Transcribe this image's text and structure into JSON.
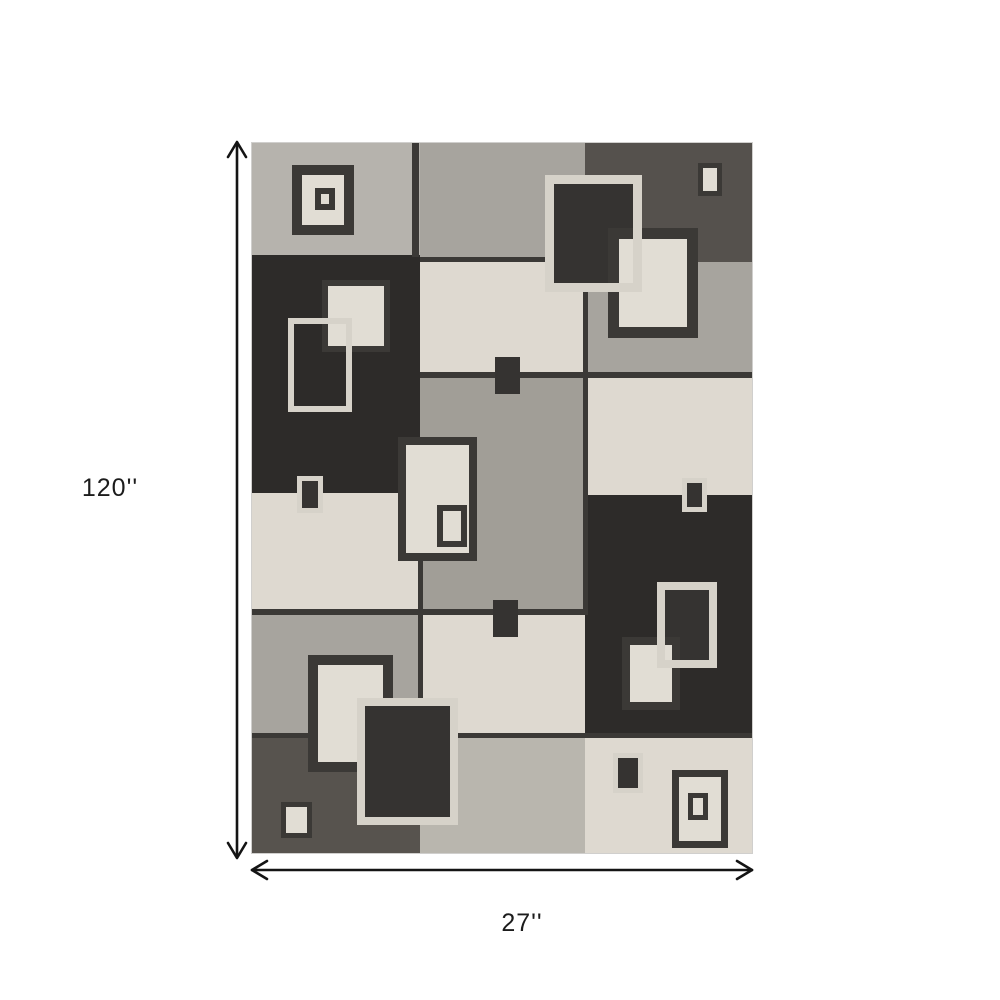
{
  "page": {
    "background": "#ffffff",
    "label_color": "#1c1c1c",
    "arrow_color": "#141414"
  },
  "dimensions": {
    "height_label": "120''",
    "width_label": "27''"
  },
  "rug": {
    "position": {
      "x": 252,
      "y": 143,
      "width": 500,
      "height": 710
    },
    "colors": {
      "black": "#2d2b29",
      "charcoal": "#55514d",
      "dark_gray": "#57534e",
      "medium_gray": "#a7a49e",
      "medium_gray2": "#a19e97",
      "light_gray": "#b6b3ad",
      "pale_gray": "#b9b6ae",
      "cream": "#ded9d0",
      "line": "#3b3936",
      "cream_border": "#d6d2c9",
      "dark_fill": "#353331",
      "cream_fill": "#e1ddd4"
    },
    "patches": [
      {
        "id": "a1",
        "x": 0,
        "y": 0,
        "w": 168,
        "h": 112,
        "color": "light_gray",
        "tx": "soft"
      },
      {
        "id": "a2",
        "x": 0,
        "y": 112,
        "w": 168,
        "h": 238,
        "color": "black",
        "tx": "strong"
      },
      {
        "id": "a3",
        "x": 0,
        "y": 350,
        "w": 168,
        "h": 118,
        "color": "cream",
        "tx": "cream"
      },
      {
        "id": "a4",
        "x": 0,
        "y": 468,
        "w": 168,
        "h": 124,
        "color": "medium_gray",
        "tx": "soft"
      },
      {
        "id": "a5",
        "x": 0,
        "y": 592,
        "w": 168,
        "h": 118,
        "color": "dark_gray",
        "tx": "strong"
      },
      {
        "id": "b1",
        "x": 168,
        "y": 0,
        "w": 165,
        "h": 117,
        "color": "medium_gray",
        "tx": "soft"
      },
      {
        "id": "b2",
        "x": 168,
        "y": 117,
        "w": 165,
        "h": 113,
        "color": "cream",
        "tx": "cream"
      },
      {
        "id": "b3",
        "x": 168,
        "y": 230,
        "w": 165,
        "h": 242,
        "color": "medium_gray2",
        "tx": "soft"
      },
      {
        "id": "b4",
        "x": 168,
        "y": 472,
        "w": 165,
        "h": 120,
        "color": "cream",
        "tx": "cream"
      },
      {
        "id": "b5",
        "x": 168,
        "y": 592,
        "w": 165,
        "h": 118,
        "color": "pale_gray",
        "tx": "soft"
      },
      {
        "id": "c1",
        "x": 333,
        "y": 0,
        "w": 167,
        "h": 119,
        "color": "charcoal",
        "tx": "strong"
      },
      {
        "id": "c2",
        "x": 333,
        "y": 119,
        "w": 167,
        "h": 115,
        "color": "medium_gray",
        "tx": "soft"
      },
      {
        "id": "c3",
        "x": 333,
        "y": 234,
        "w": 167,
        "h": 118,
        "color": "cream",
        "tx": "cream"
      },
      {
        "id": "c4",
        "x": 333,
        "y": 352,
        "w": 167,
        "h": 240,
        "color": "black",
        "tx": "strong"
      },
      {
        "id": "c5",
        "x": 333,
        "y": 592,
        "w": 167,
        "h": 118,
        "color": "cream",
        "tx": "cream"
      }
    ],
    "seams": [
      {
        "id": "seam-a1-b1",
        "x": 160,
        "y": 0,
        "w": 7,
        "h": 114,
        "color": "line"
      },
      {
        "id": "seam-b1-b2",
        "x": 168,
        "y": 114,
        "w": 165,
        "h": 5,
        "color": "line"
      },
      {
        "id": "seam-b2-b3",
        "x": 168,
        "y": 229,
        "w": 332,
        "h": 6,
        "color": "line"
      },
      {
        "id": "seam-a3-a4",
        "x": 0,
        "y": 466,
        "w": 333,
        "h": 6,
        "color": "line"
      },
      {
        "id": "seam-row-bottom",
        "x": 0,
        "y": 590,
        "w": 500,
        "h": 5,
        "color": "line"
      },
      {
        "id": "seam-a-b-vert",
        "x": 166,
        "y": 350,
        "w": 5,
        "h": 242,
        "color": "line"
      },
      {
        "id": "seam-b-c-vert",
        "x": 331,
        "y": 117,
        "w": 5,
        "h": 355,
        "color": "line"
      }
    ],
    "motifs": [
      {
        "id": "m1-outer",
        "x": 40,
        "y": 22,
        "w": 62,
        "h": 70,
        "border": 10,
        "border_color": "line",
        "fill": "cream_fill",
        "tx": "cream"
      },
      {
        "id": "m1-inner",
        "x": 63,
        "y": 45,
        "w": 20,
        "h": 22,
        "border": 6,
        "border_color": "line",
        "fill": "cream_fill"
      },
      {
        "id": "m2",
        "x": 446,
        "y": 20,
        "w": 24,
        "h": 33,
        "border": 5,
        "border_color": "line",
        "fill": "cream_fill"
      },
      {
        "id": "m3",
        "x": 293,
        "y": 32,
        "w": 97,
        "h": 117,
        "border": 9,
        "border_color": "cream_border",
        "fill": "dark_fill",
        "tx": "dark"
      },
      {
        "id": "m4",
        "x": 356,
        "y": 85,
        "w": 90,
        "h": 110,
        "border": 11,
        "border_color": "line",
        "fill": "cream_fill",
        "tx": "cream"
      },
      {
        "id": "m3-outline",
        "x": 293,
        "y": 32,
        "w": 97,
        "h": 117,
        "border": 9,
        "border_color": "cream_border",
        "fill": null
      },
      {
        "id": "m6",
        "x": 70,
        "y": 137,
        "w": 68,
        "h": 72,
        "border": 6,
        "border_color": "line",
        "fill": "cream_fill",
        "tx": "cream"
      },
      {
        "id": "m5-outline",
        "x": 36,
        "y": 175,
        "w": 64,
        "h": 94,
        "border": 6,
        "border_color": "cream_border",
        "fill": null
      },
      {
        "id": "m7",
        "x": 45,
        "y": 333,
        "w": 26,
        "h": 37,
        "border": 5,
        "border_color": "cream_border",
        "fill": "dark_fill"
      },
      {
        "id": "m8",
        "x": 243,
        "y": 214,
        "w": 25,
        "h": 37,
        "border": 0,
        "border_color": "line",
        "fill": "dark_fill"
      },
      {
        "id": "m9-outer",
        "x": 146,
        "y": 294,
        "w": 79,
        "h": 124,
        "border": 8,
        "border_color": "line",
        "fill": "cream_fill",
        "tx": "cream"
      },
      {
        "id": "m9-inner",
        "x": 185,
        "y": 362,
        "w": 30,
        "h": 42,
        "border": 6,
        "border_color": "line",
        "fill": "cream_fill"
      },
      {
        "id": "m10",
        "x": 241,
        "y": 457,
        "w": 25,
        "h": 37,
        "border": 0,
        "border_color": "line",
        "fill": "dark_fill"
      },
      {
        "id": "m11",
        "x": 430,
        "y": 335,
        "w": 25,
        "h": 34,
        "border": 5,
        "border_color": "cream_border",
        "fill": "dark_fill"
      },
      {
        "id": "m12",
        "x": 405,
        "y": 439,
        "w": 60,
        "h": 86,
        "border": 8,
        "border_color": "cream_border",
        "fill": "dark_fill",
        "tx": "dark"
      },
      {
        "id": "m13",
        "x": 370,
        "y": 494,
        "w": 58,
        "h": 73,
        "border": 8,
        "border_color": "line",
        "fill": "cream_fill",
        "tx": "cream"
      },
      {
        "id": "m12-outline",
        "x": 405,
        "y": 439,
        "w": 60,
        "h": 86,
        "border": 8,
        "border_color": "cream_border",
        "fill": null
      },
      {
        "id": "m14a",
        "x": 56,
        "y": 512,
        "w": 85,
        "h": 117,
        "border": 10,
        "border_color": "line",
        "fill": "cream_fill",
        "tx": "cream"
      },
      {
        "id": "m14b",
        "x": 105,
        "y": 555,
        "w": 101,
        "h": 127,
        "border": 8,
        "border_color": "cream_border",
        "fill": "dark_fill",
        "tx": "dark"
      },
      {
        "id": "m15",
        "x": 29,
        "y": 659,
        "w": 31,
        "h": 36,
        "border": 5,
        "border_color": "line",
        "fill": "cream_fill"
      },
      {
        "id": "m16",
        "x": 361,
        "y": 610,
        "w": 30,
        "h": 40,
        "border": 5,
        "border_color": "cream_border",
        "fill": "dark_fill"
      },
      {
        "id": "m17-outer",
        "x": 420,
        "y": 627,
        "w": 56,
        "h": 78,
        "border": 7,
        "border_color": "line",
        "fill": "cream_fill",
        "tx": "cream"
      },
      {
        "id": "m17-inner",
        "x": 436,
        "y": 650,
        "w": 20,
        "h": 27,
        "border": 5,
        "border_color": "line",
        "fill": "cream_fill"
      }
    ]
  }
}
